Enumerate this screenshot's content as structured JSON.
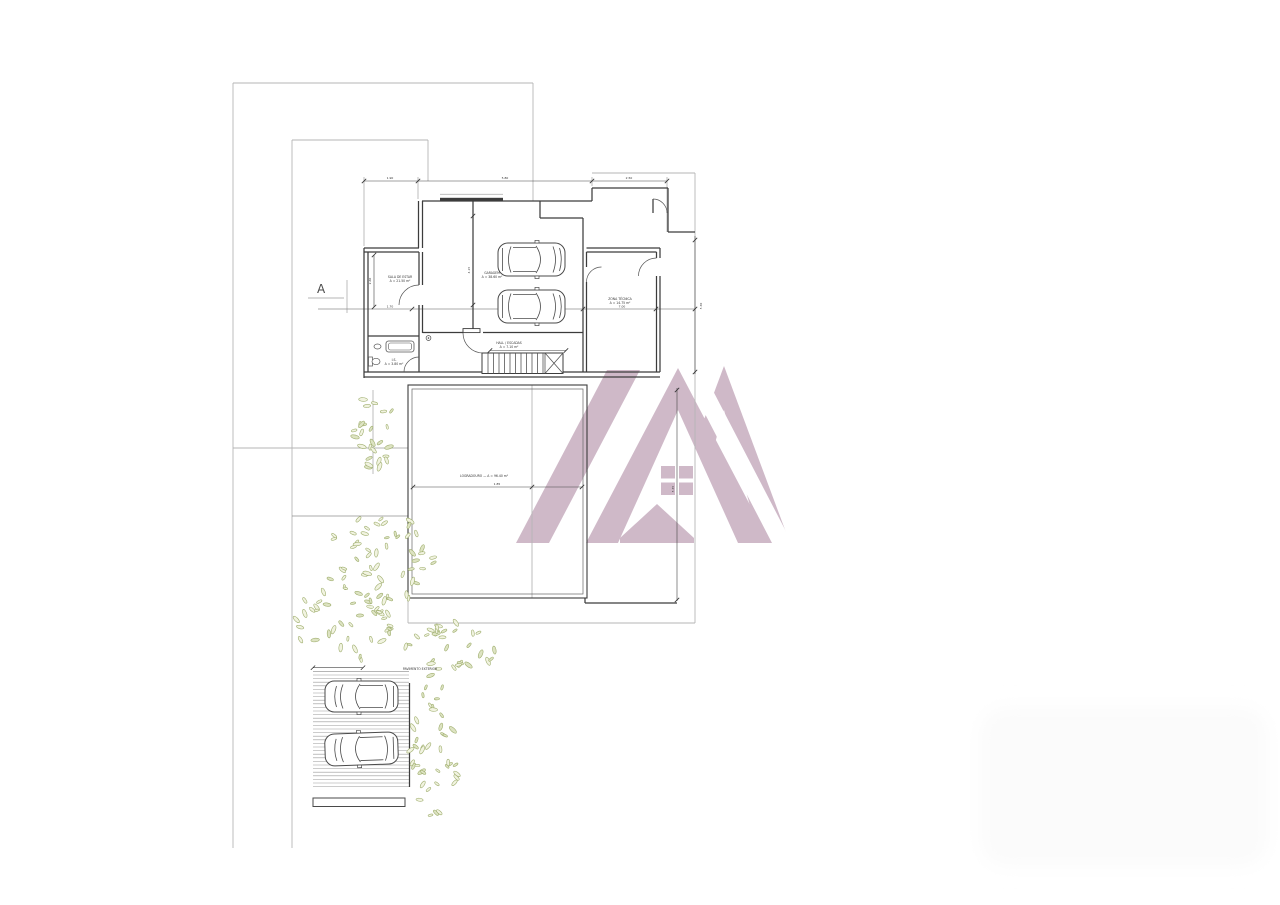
{
  "canvas": {
    "width": 1280,
    "height": 905
  },
  "palette": {
    "background": "#ffffff",
    "wall": "#3c3c3c",
    "line_light": "#b5b5b5",
    "line_medium": "#8f8f8f",
    "dim": "#444444",
    "text": "#333333",
    "foliage_stroke": "#9fae6e",
    "foliage_fill": "#f1f3e0",
    "watermark": "#cfb9c8",
    "hatch": "#9a9a9a",
    "car": "#4a4a4a",
    "corner_blob": "#fbfbfb"
  },
  "section_marker": {
    "label": "A"
  },
  "watermark": {
    "name": "real-estate-logo-watermark",
    "window_panes": 4
  },
  "plan": {
    "room_labels": [
      {
        "id": "living-room",
        "lines": [
          "SALA DE ESTAR",
          "A = 21.50 m²"
        ],
        "x": 400,
        "y": 278
      },
      {
        "id": "garage",
        "lines": [
          "GARAGEM",
          "A = 38.60 m²"
        ],
        "x": 492,
        "y": 274
      },
      {
        "id": "storage",
        "lines": [
          "ZONA TÉCNICA",
          "A = 14.75 m²"
        ],
        "x": 620,
        "y": 300
      },
      {
        "id": "hall-stairs",
        "lines": [
          "HALL / ESCADAS",
          "A = 7.10 m²"
        ],
        "x": 509,
        "y": 344
      },
      {
        "id": "bathroom",
        "lines": [
          "I.S.",
          "A = 3.80 m²"
        ],
        "x": 394,
        "y": 361
      },
      {
        "id": "terrace",
        "lines": [
          "LOGRADOURO — A = 96.40 m²"
        ],
        "x": 484,
        "y": 477
      },
      {
        "id": "parking",
        "lines": [
          "PAVIMENTO EXTERIOR"
        ],
        "x": 420,
        "y": 670
      }
    ],
    "dim_labels": [
      {
        "t": "1.90",
        "x": 390,
        "y": 179
      },
      {
        "t": "5.80",
        "x": 505,
        "y": 179
      },
      {
        "t": "2.50",
        "x": 629,
        "y": 179
      },
      {
        "t": "1.70",
        "x": 390,
        "y": 307.5
      },
      {
        "t": "7.00",
        "x": 622,
        "y": 307.5
      },
      {
        "t": "1.85",
        "x": 497,
        "y": 485
      },
      {
        "t": "5.30",
        "x": 702,
        "y": 306,
        "r": true
      },
      {
        "t": "5.35",
        "x": 674,
        "y": 489,
        "r": true
      },
      {
        "t": "2.60",
        "x": 371,
        "y": 281,
        "r": true
      },
      {
        "t": "4.15",
        "x": 470,
        "y": 270,
        "r": true
      }
    ],
    "boundary_lines": [
      [
        233,
        83,
        533,
        83
      ],
      [
        233,
        83,
        233,
        848
      ],
      [
        292,
        140,
        428,
        140
      ],
      [
        292,
        140,
        292,
        848
      ],
      [
        428,
        140,
        428,
        181
      ],
      [
        533,
        83,
        533,
        201
      ],
      [
        592,
        173,
        695,
        173
      ],
      [
        695,
        173,
        695,
        623
      ],
      [
        408,
        623,
        695,
        623
      ],
      [
        408,
        598,
        408,
        623
      ],
      [
        233,
        448,
        408,
        448
      ],
      [
        373,
        390,
        373,
        474
      ],
      [
        347,
        280,
        347,
        313
      ],
      [
        308,
        298,
        344,
        298
      ],
      [
        532,
        385,
        532,
        598
      ],
      [
        440,
        194.3,
        503,
        194.3
      ],
      [
        364,
        177,
        364,
        246
      ],
      [
        418,
        177,
        418,
        199
      ],
      [
        592,
        177,
        592,
        186
      ],
      [
        667,
        177,
        667,
        232
      ],
      [
        313,
        671.5,
        409,
        671.5
      ]
    ],
    "medium_lines": [
      [
        318,
        309,
        695,
        309
      ],
      [
        292,
        516,
        408,
        516
      ]
    ],
    "wall_lines": [
      [
        422,
        201,
        592,
        201
      ],
      [
        540,
        201,
        540,
        218
      ],
      [
        540,
        218,
        583,
        218
      ],
      [
        583,
        218,
        583,
        332
      ],
      [
        592,
        188,
        668,
        188
      ],
      [
        592,
        188,
        592,
        201
      ],
      [
        668,
        188,
        668,
        232
      ],
      [
        668,
        232,
        695,
        232
      ],
      [
        418.5,
        201,
        418.5,
        248
      ],
      [
        422.5,
        201,
        422.5,
        248
      ],
      [
        364,
        248,
        419,
        248
      ],
      [
        364,
        252,
        419,
        252
      ],
      [
        364,
        248,
        364,
        378
      ],
      [
        368,
        252,
        368,
        372
      ],
      [
        419,
        252,
        419,
        285
      ],
      [
        419,
        305,
        419,
        372
      ],
      [
        422.5,
        252,
        422.5,
        285
      ],
      [
        422.5,
        305,
        422.5,
        333
      ],
      [
        422.5,
        332.5,
        463,
        332.5
      ],
      [
        483,
        332.5,
        583,
        332.5
      ],
      [
        473,
        201,
        473,
        332
      ],
      [
        364,
        372,
        660,
        372
      ],
      [
        364,
        377,
        660,
        377
      ],
      [
        368,
        336,
        419,
        336
      ],
      [
        583,
        332,
        583,
        372
      ],
      [
        586.5,
        248,
        660,
        248
      ],
      [
        586.5,
        252,
        656.5,
        252
      ],
      [
        586.5,
        252,
        586.5,
        267
      ],
      [
        586.5,
        282,
        586.5,
        372
      ],
      [
        656.5,
        252,
        656.5,
        258
      ],
      [
        656.5,
        276,
        656.5,
        372
      ],
      [
        660,
        248,
        660,
        258
      ],
      [
        660,
        276,
        660,
        372
      ],
      [
        585,
        598,
        585,
        603
      ],
      [
        585,
        603,
        677,
        603
      ],
      [
        653,
        199,
        653,
        213
      ],
      [
        409.5,
        683,
        409.5,
        787
      ]
    ],
    "window_band": {
      "x": 440,
      "y": 197.8,
      "w": 63,
      "h": 2.8
    },
    "door_leaf": {
      "x": 463,
      "y": 328.6,
      "w": 17,
      "h": 4
    },
    "arcs": [
      "M 419,285 A 20 20 0 0 0 399,305",
      "M 419,357 A 15 15 0 0 0 404,372",
      "M 463,333 A 20 20 0 0 0 483,353",
      "M 586.5,282 A 15 15 0 0 1 601.5,267",
      "M 656.5,258 A 18 18 0 0 0 638.5,276",
      "M 653,199 A 14 14 0 0 1 667,213"
    ],
    "terrace": {
      "outer": [
        408,
        385,
        179,
        213
      ],
      "inner": [
        412,
        389,
        171,
        205
      ]
    },
    "planter": {
      "x": 313,
      "y": 798,
      "w": 92,
      "h": 8.5
    },
    "stairs": {
      "x": 482,
      "y": 353,
      "w": 81,
      "h": 20.5,
      "tread_x0": 488,
      "tread_step": 5.5,
      "tread_n": 11,
      "x_panel": 545
    },
    "hatch": {
      "x": 313,
      "y": 675,
      "w": 96,
      "h": 114,
      "gap": 3.6
    },
    "drain": {
      "x": 428.5,
      "y": 338
    },
    "bath": {
      "tub_outer": [
        386,
        341,
        28,
        11
      ],
      "tub_inner": [
        388.5,
        343,
        23,
        7
      ],
      "sink": [
        377.5,
        346.5,
        3.5,
        2.5
      ],
      "toilet_tank": [
        368.5,
        357,
        4,
        9
      ],
      "toilet_bowl": [
        376,
        361.5,
        4,
        3.2
      ]
    },
    "dims": [
      {
        "l": [
          364,
          181,
          418,
          181
        ],
        "t": [
          [
            364,
            181
          ],
          [
            418,
            181
          ]
        ]
      },
      {
        "l": [
          418,
          181,
          592,
          181
        ],
        "t": [
          [
            592,
            181
          ]
        ]
      },
      {
        "l": [
          592,
          181,
          667,
          181
        ],
        "t": [
          [
            667,
            181
          ]
        ]
      },
      {
        "l": [
          695,
          236,
          695,
          374
        ],
        "t": [
          [
            695,
            240
          ],
          [
            695,
            372
          ]
        ]
      },
      {
        "l": [
          677,
          388,
          677,
          601
        ],
        "t": [
          [
            677,
            390
          ],
          [
            677,
            600
          ]
        ]
      },
      {
        "l": [
          374,
          255,
          374,
          307
        ],
        "t": [
          [
            374,
            255
          ],
          [
            374,
            307
          ]
        ]
      },
      {
        "l": [
          412,
          487,
          583,
          487
        ],
        "t": [
          [
            413,
            487
          ],
          [
            532,
            487
          ],
          [
            582,
            487
          ]
        ]
      },
      {
        "l": [
          473,
          216,
          473,
          305
        ],
        "t": [
          [
            473,
            216
          ],
          [
            473,
            305
          ]
        ]
      },
      {
        "l": [
          490,
          350.5,
          566,
          350.5
        ],
        "t": [
          [
            490,
            350.5
          ],
          [
            566,
            350.5
          ]
        ]
      },
      {
        "l": [
          313,
          667.7,
          363,
          667.7
        ],
        "t": [
          [
            313,
            667.7
          ],
          [
            363,
            667.7
          ]
        ]
      }
    ],
    "dim_ticks_on_section": [
      [
        412,
        309
      ],
      [
        583,
        309
      ],
      [
        656,
        309
      ],
      [
        695,
        309
      ]
    ],
    "cars": [
      {
        "x": 498,
        "y": 243,
        "w": 67,
        "h": 33,
        "flip": false,
        "rot": 0
      },
      {
        "x": 498,
        "y": 290,
        "w": 67,
        "h": 33,
        "flip": false,
        "rot": 0
      },
      {
        "x": 325,
        "y": 681,
        "w": 73,
        "h": 31,
        "flip": true,
        "rot": 0
      },
      {
        "x": 325,
        "y": 733,
        "w": 73,
        "h": 32,
        "flip": true,
        "rot": -2
      }
    ],
    "trees": [
      {
        "cx": 374,
        "cy": 431,
        "rx": 20,
        "ry": 43,
        "n": 26
      },
      {
        "cx": 381,
        "cy": 560,
        "rx": 57,
        "ry": 46,
        "n": 55
      },
      {
        "cx": 340,
        "cy": 625,
        "rx": 52,
        "ry": 40,
        "n": 40
      },
      {
        "cx": 452,
        "cy": 645,
        "rx": 47,
        "ry": 26,
        "n": 30
      },
      {
        "cx": 434,
        "cy": 745,
        "rx": 27,
        "ry": 74,
        "n": 42
      }
    ],
    "watermark_shapes": {
      "right_triangle": "724,366 790,543 658,543",
      "right_inner_white": "724,410 760,543 688,543",
      "notch_white": [
        686,
        504,
        38,
        39
      ],
      "gap_band_white": "676,358 696,358 792,543 772,543",
      "main_triangle": "678,368 770,543 586,543",
      "main_inner_white": "678,410 738,543 618,543",
      "windows": [
        [
          661,
          466,
          14,
          12.5
        ],
        [
          679,
          466,
          14,
          12.5
        ],
        [
          661,
          482.5,
          14,
          12.5
        ],
        [
          679,
          482.5,
          14,
          12.5
        ]
      ],
      "house_arrow": "620,543 620,538 657,504 694,538 694,543",
      "stripe": "516,543 549,543 640,370 607,370"
    },
    "corner_blob": {
      "x": 980,
      "y": 707,
      "w": 288,
      "h": 160
    }
  }
}
